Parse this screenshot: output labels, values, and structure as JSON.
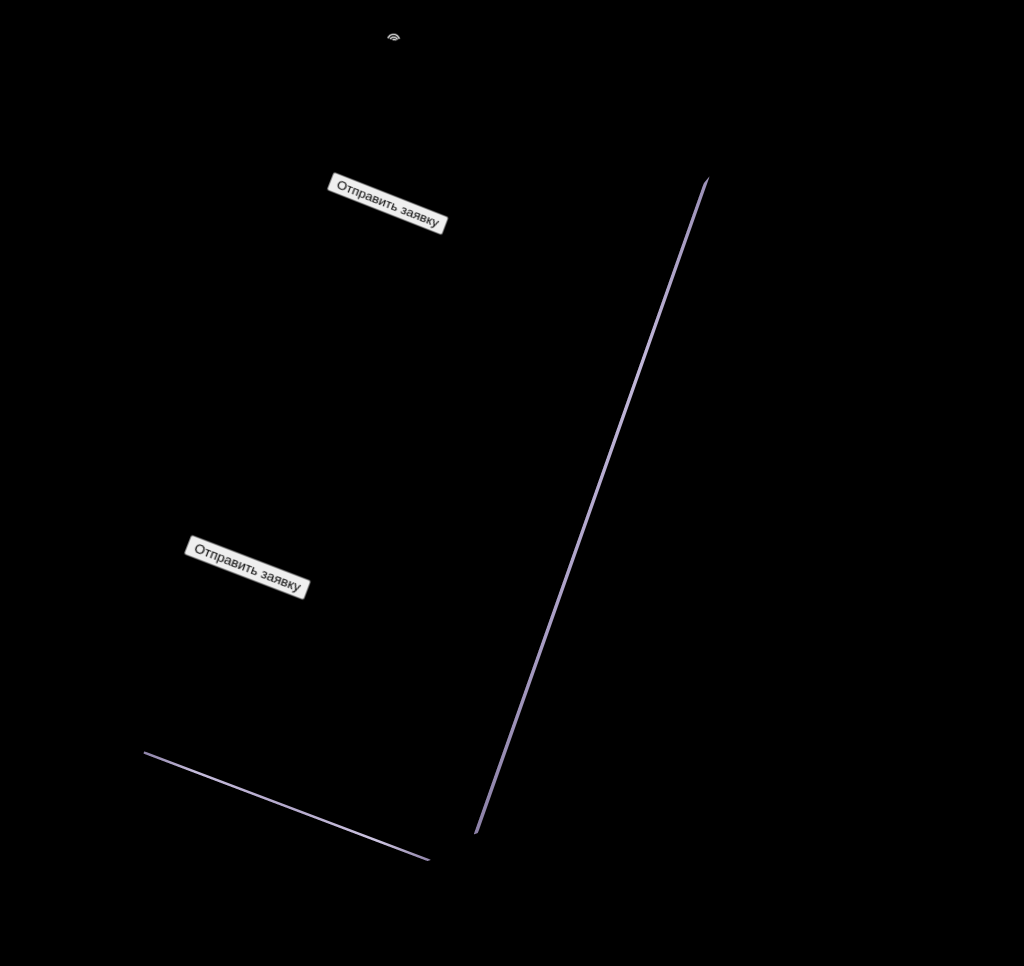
{
  "page": {
    "background_color": "#000000"
  },
  "phone": {
    "frame_color": "#c0b5d8",
    "island_name": "dynamic-island",
    "camera_name": "front-camera"
  },
  "site": {
    "header": {
      "left_links": [
        {
          "label": "О нас"
        },
        {
          "label": "Преимущества"
        },
        {
          "label": "Портфолио"
        }
      ],
      "logo_text": "рондо",
      "right_links": [
        {
          "label": "Стоимость"
        },
        {
          "label": "Как мы работаем"
        },
        {
          "label": "Контакты"
        }
      ]
    },
    "hero": {
      "title": "Мебель на заказ",
      "subtitle": "Изготовим любую корпусную мебель по вашим размерам",
      "cta_label": "Отправить заявку",
      "accent_color": "#27a06a"
    },
    "reasons": {
      "title": "3 причины для индивидуального заказа",
      "intro": "Вы получаете кухню на заказ, гардеробную или любую другую корпусную мебель, изготовленную индивидуально под Ваш интерьер",
      "items": [
        {
          "marker": "- 1 -",
          "title": "Дизайн будущей мебели определяете Вы",
          "text": "Вы заказываете именно ту мебель, которая идеально впишется в интерьер Вашего пространства"
        },
        {
          "marker": "- 2 -",
          "title": "Всё для заказа в одном месте",
          "text": "Обсуждение проекта, выбор всех материалов и комплектующих - в одном месте"
        },
        {
          "marker": "- 3 -",
          "title": "Вы сами определяете бюджет",
          "text": "Широкий ассортимент фурнитуры и материалов позволит сделать мебель на любую сумму"
        }
      ],
      "cta_label": "Отправить заявку"
    },
    "works": {
      "title": "Наши работы",
      "subtitle": "Мебель на заказ по индивидуальным размерам",
      "gallery": [
        {
          "name": "kitchen-white-led-shelf"
        },
        {
          "name": "kitchen-cream-wood-counter"
        },
        {
          "name": "kitchen-marble-backsplash"
        },
        {
          "name": "kitchen-blue-corner"
        },
        {
          "name": "kitchen-white-dark-countertop"
        },
        {
          "name": "kitchen-dark-purple-lower"
        },
        {
          "name": "kitchen-classic-cream"
        },
        {
          "name": "bathroom-double-vessel-sinks"
        }
      ]
    },
    "materials": {
      "title": "Материалы для фасадов"
    }
  }
}
